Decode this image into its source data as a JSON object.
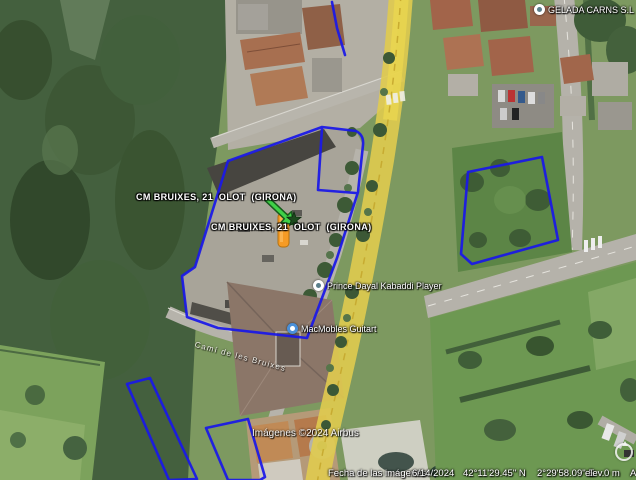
{
  "placemarks": {
    "primary": {
      "label": "CM BRUIXES, 21  OLOT  (GIRONA)"
    },
    "secondary": {
      "label": "CM BRUIXES, 21  OLOT  (GIRONA)"
    }
  },
  "pois": {
    "gelada": {
      "label": "GELADA CARNS S.L"
    },
    "kabaddi": {
      "label": "Prince Dayal Kabaddi Player"
    },
    "mobles": {
      "label": "MacMobles Guitart"
    }
  },
  "map": {
    "road_label": "Camí de les Bruixes",
    "attribution": "Imágenes ©2024 Airbus"
  },
  "status_bar": {
    "imagery_date_label": "Fecha de las imágenes:",
    "imagery_date": "6/14/2024",
    "latitude": "42°11'29.45\" N",
    "longitude": "2°29'58.09\" E",
    "elevation_label": "elev.",
    "elevation": "0 m",
    "truncated_right": "A"
  },
  "colors": {
    "parcel_outline": "#1a18e8",
    "arrow_green": "#3fd147",
    "pin_orange": "#f59b25",
    "road_highlight": "#e0cb4f"
  }
}
